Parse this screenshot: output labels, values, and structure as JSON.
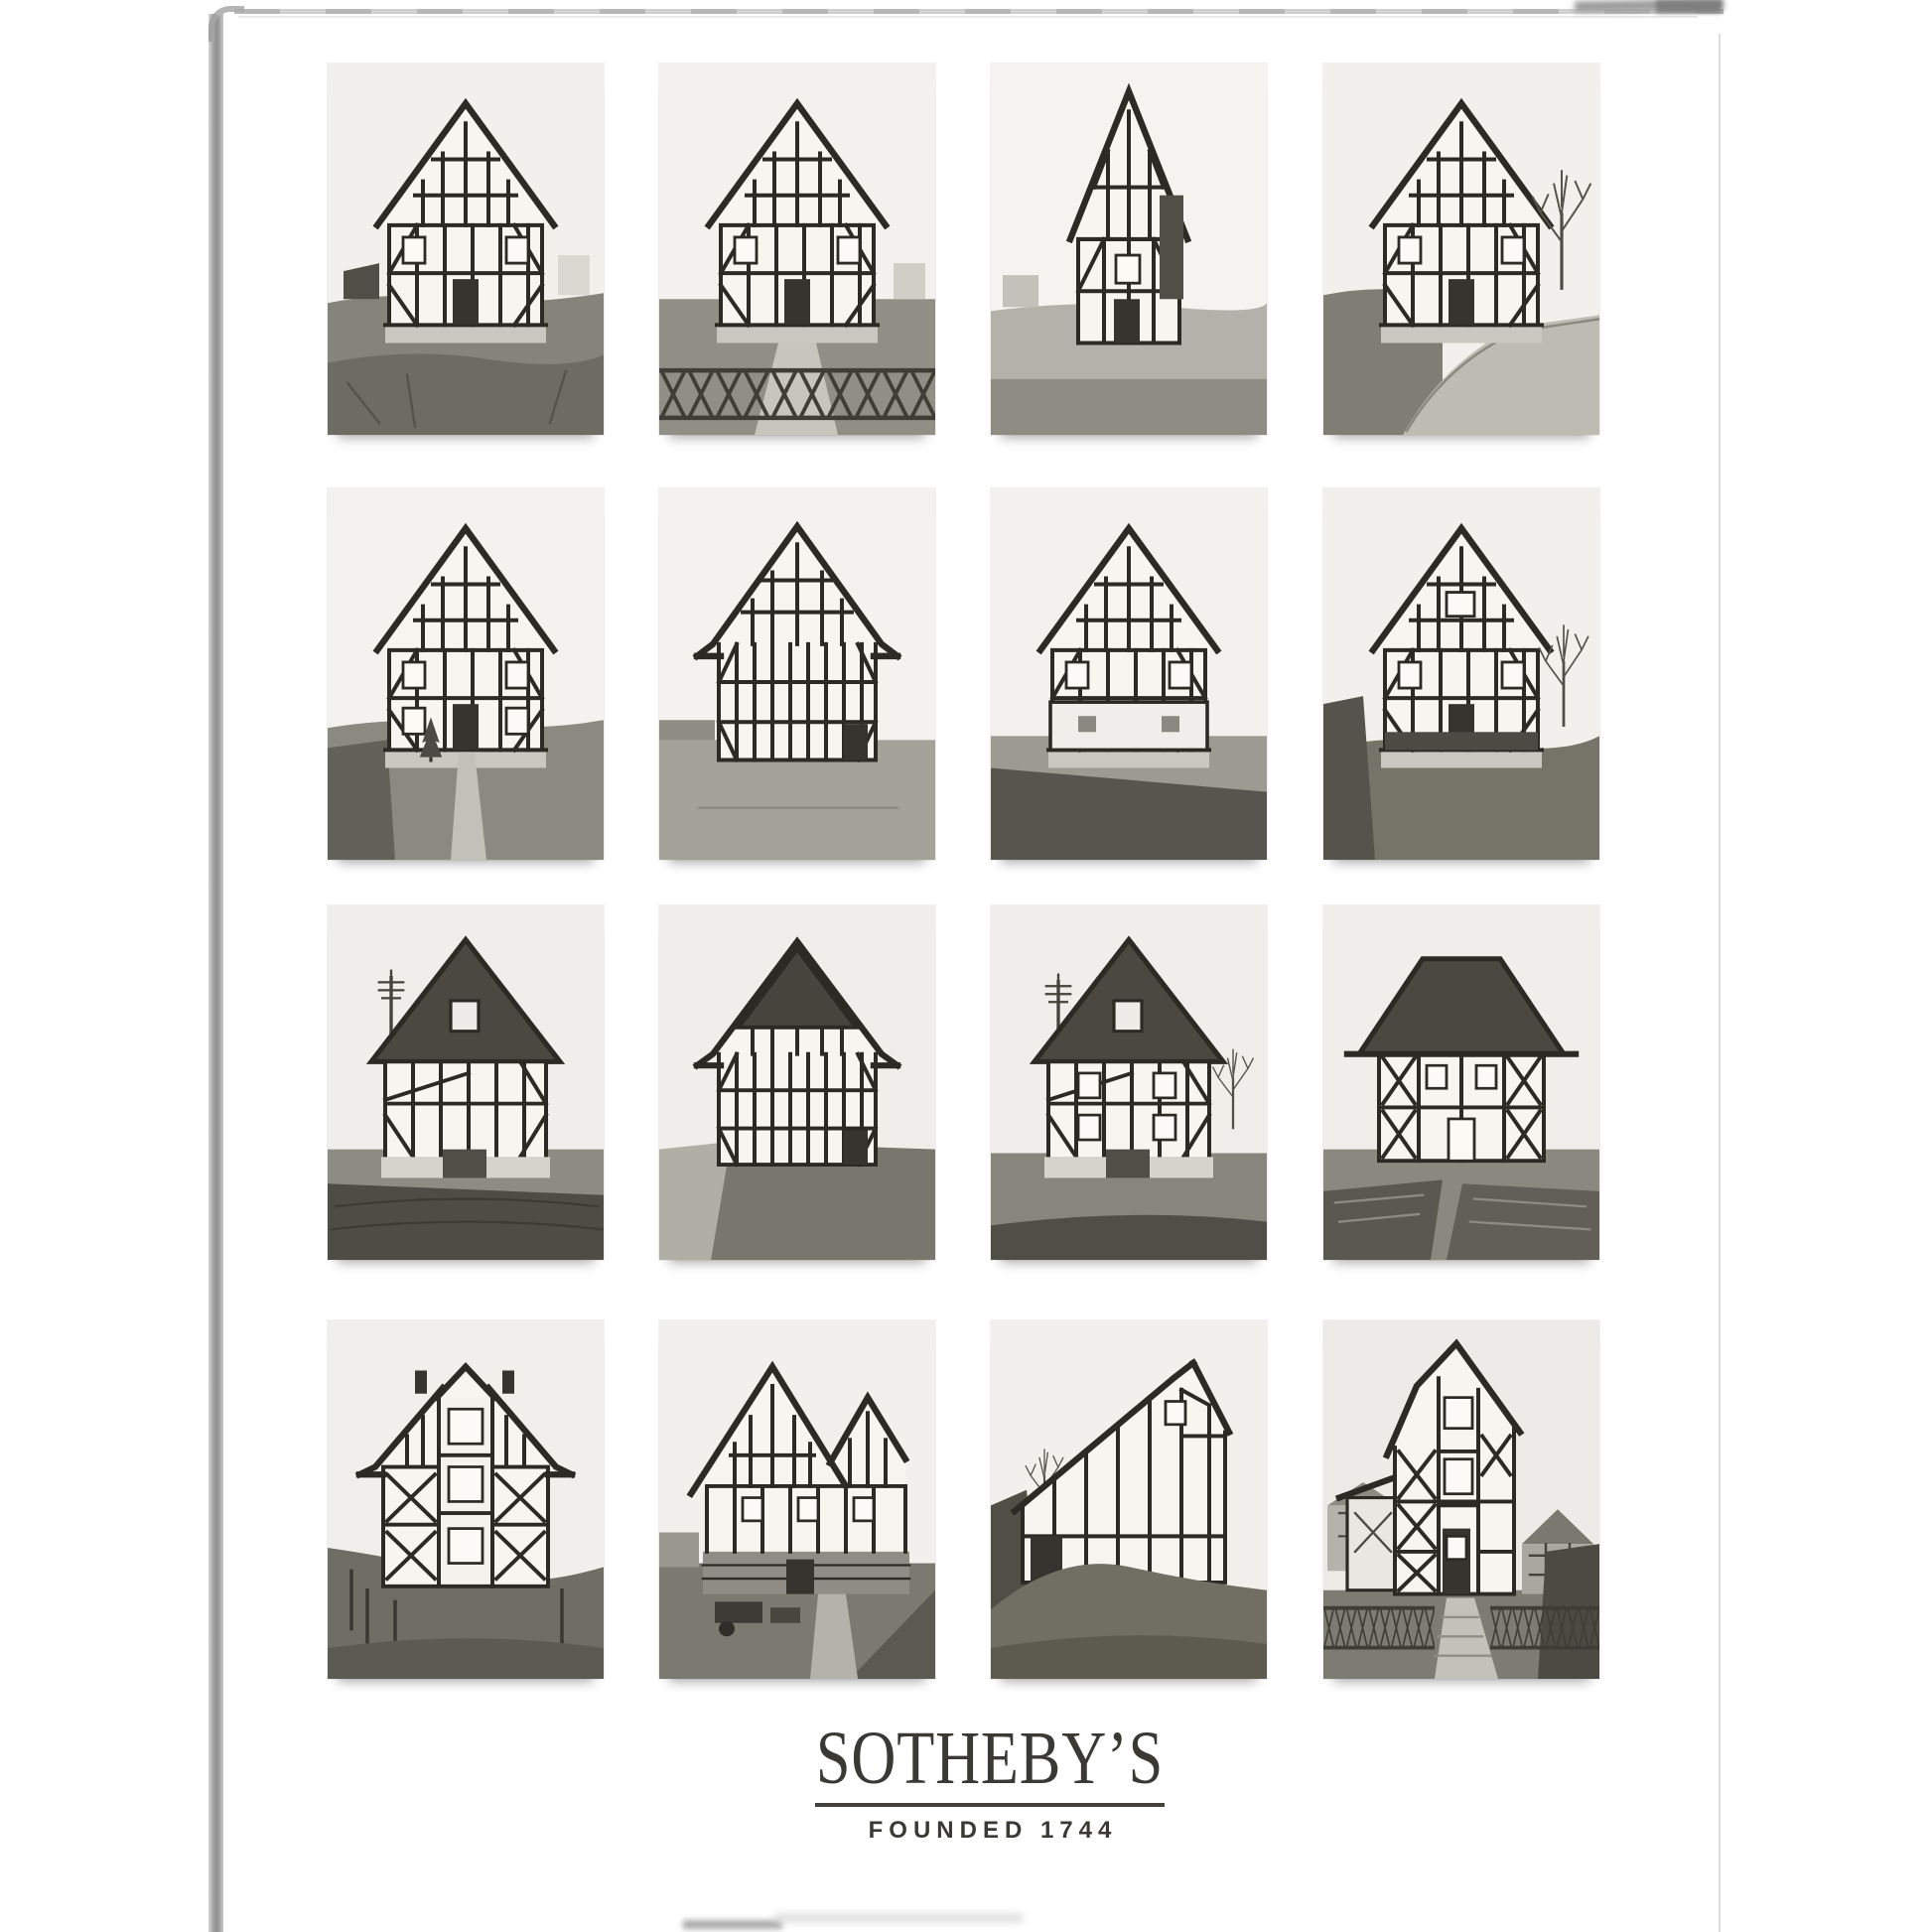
{
  "page": {
    "background": "#ffffff",
    "kind_label": "Scanned catalogue cover with photo grid",
    "photo_rows": 4,
    "photo_cols": 4
  },
  "logo": {
    "wordmark": "SOTHEBY’S",
    "tagline": "FOUNDED 1744",
    "color": "#3a3933"
  },
  "grid": {
    "photos": [
      {
        "id": "r1c1",
        "description": "Black-and-white photograph: half-timbered gabled house with bare rubble yard and small shed"
      },
      {
        "id": "r1c2",
        "description": "Black-and-white photograph: half-timbered house behind a diamond lattice fence"
      },
      {
        "id": "r1c3",
        "description": "Black-and-white photograph: tall narrow half-timbered house with pale facade"
      },
      {
        "id": "r1c4",
        "description": "Black-and-white photograph: half-timbered house beside a bare tree and curving lane"
      },
      {
        "id": "r2c1",
        "description": "Black-and-white photograph: three-storey half-timbered house with garden path and small conifer"
      },
      {
        "id": "r2c2",
        "description": "Black-and-white photograph: broad half-timbered gable facade with dense studs and corner door"
      },
      {
        "id": "r2c3",
        "description": "Black-and-white photograph: half-timbered house with plastered ground floor above a dark slope"
      },
      {
        "id": "r2c4",
        "description": "Black-and-white photograph: half-timbered house on a grassy bank with bare tree"
      },
      {
        "id": "r3c1",
        "description": "Black-and-white photograph: house with dark slated gable roof, attic window and power pole"
      },
      {
        "id": "r3c2",
        "description": "Black-and-white photograph: half-timbered facade with dark boarded gable beside a lane"
      },
      {
        "id": "r3c3",
        "description": "Black-and-white photograph: house with dark slate roof, windows and power pole over a garden"
      },
      {
        "id": "r3c4",
        "description": "Black-and-white photograph: house with wide dark hipped roof and cross-braced facade"
      },
      {
        "id": "r4c1",
        "description": "Black-and-white photograph: large half-timbered house with central bay, gablet and cross braces"
      },
      {
        "id": "r4c2",
        "description": "Black-and-white photograph: double-gabled half-timbered house with stone base and yard equipment"
      },
      {
        "id": "r4c3",
        "description": "Black-and-white photograph: asymmetric timber-framed barn on a grassy mound"
      },
      {
        "id": "r4c4",
        "description": "Black-and-white photograph: tall narrow half-timbered house behind a lattice fence with stone path"
      }
    ]
  }
}
